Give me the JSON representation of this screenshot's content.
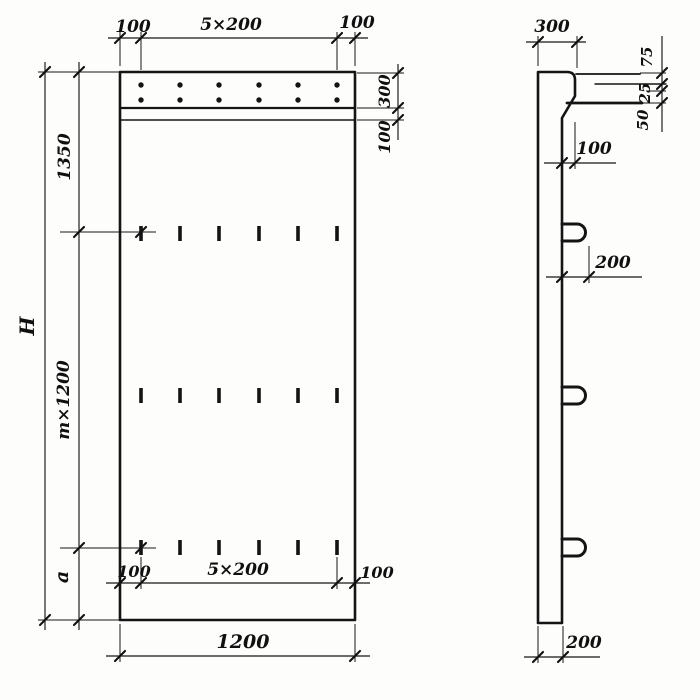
{
  "drawing": {
    "type": "technical-drawing",
    "views": [
      "front-elevation",
      "side-section"
    ],
    "front": {
      "dims_top": {
        "left": "100",
        "center": "5×200",
        "right": "100"
      },
      "dims_left": {
        "overall": "H",
        "top": "1350",
        "middle": "m×1200",
        "bottom": "a"
      },
      "dims_right": {
        "top_strip": "300",
        "sub_strip": "100"
      },
      "dims_bottom_inner": {
        "left": "100",
        "center": "5×200",
        "right": "100"
      },
      "dims_bottom": {
        "width": "1200"
      },
      "features": {
        "anchor_dot_rows": 2,
        "anchor_dots_per_row": 6,
        "slot_mark_rows": 3,
        "slot_marks_per_row": 6
      }
    },
    "side": {
      "dims_top": {
        "width": "300"
      },
      "dims_right_stack": {
        "top": "75",
        "middle": "25",
        "bottom": "50"
      },
      "dims_mid": {
        "ledge_offset": "100",
        "loop_protrusion": "200"
      },
      "dims_bottom": {
        "thickness": "200"
      },
      "features": {
        "lifting_loops": 3
      }
    },
    "colors": {
      "line": "#141414",
      "background": "#fdfdfc"
    }
  }
}
